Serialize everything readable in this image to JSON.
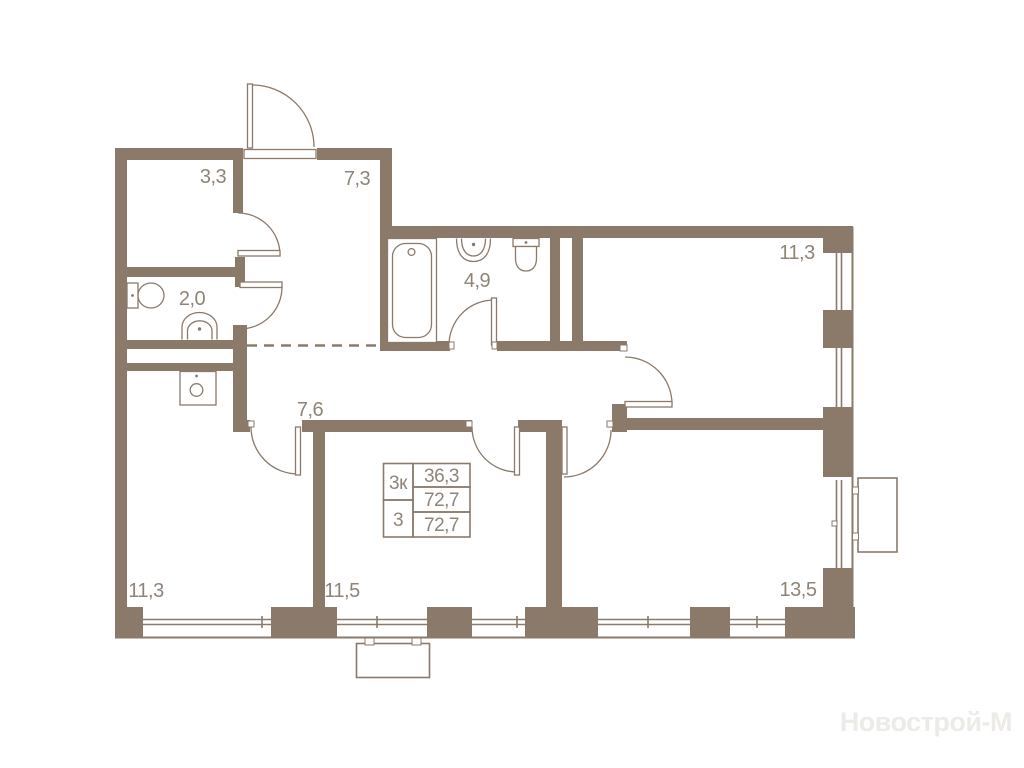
{
  "plan": {
    "watermark": "Новострой-М",
    "rooms": [
      {
        "name": "hall-small",
        "area": "3,3"
      },
      {
        "name": "entry-hall",
        "area": "7,3"
      },
      {
        "name": "wc",
        "area": "2,0"
      },
      {
        "name": "bathroom",
        "area": "4,9"
      },
      {
        "name": "bedroom-top-right",
        "area": "11,3"
      },
      {
        "name": "corridor",
        "area": "7,6"
      },
      {
        "name": "bedroom-bottom-left",
        "area": "11,3"
      },
      {
        "name": "bedroom-middle",
        "area": "11,5"
      },
      {
        "name": "living-room",
        "area": "13,5"
      }
    ],
    "info_table": {
      "type_label": "3к",
      "living_area": "36,3",
      "area_mid": "72,7",
      "rooms_count": "3",
      "total_area": "72,7"
    },
    "colors": {
      "wall": "#8b7a6a",
      "label_text": "#8f8478",
      "watermark": "#edebe8",
      "background": "#ffffff"
    }
  }
}
